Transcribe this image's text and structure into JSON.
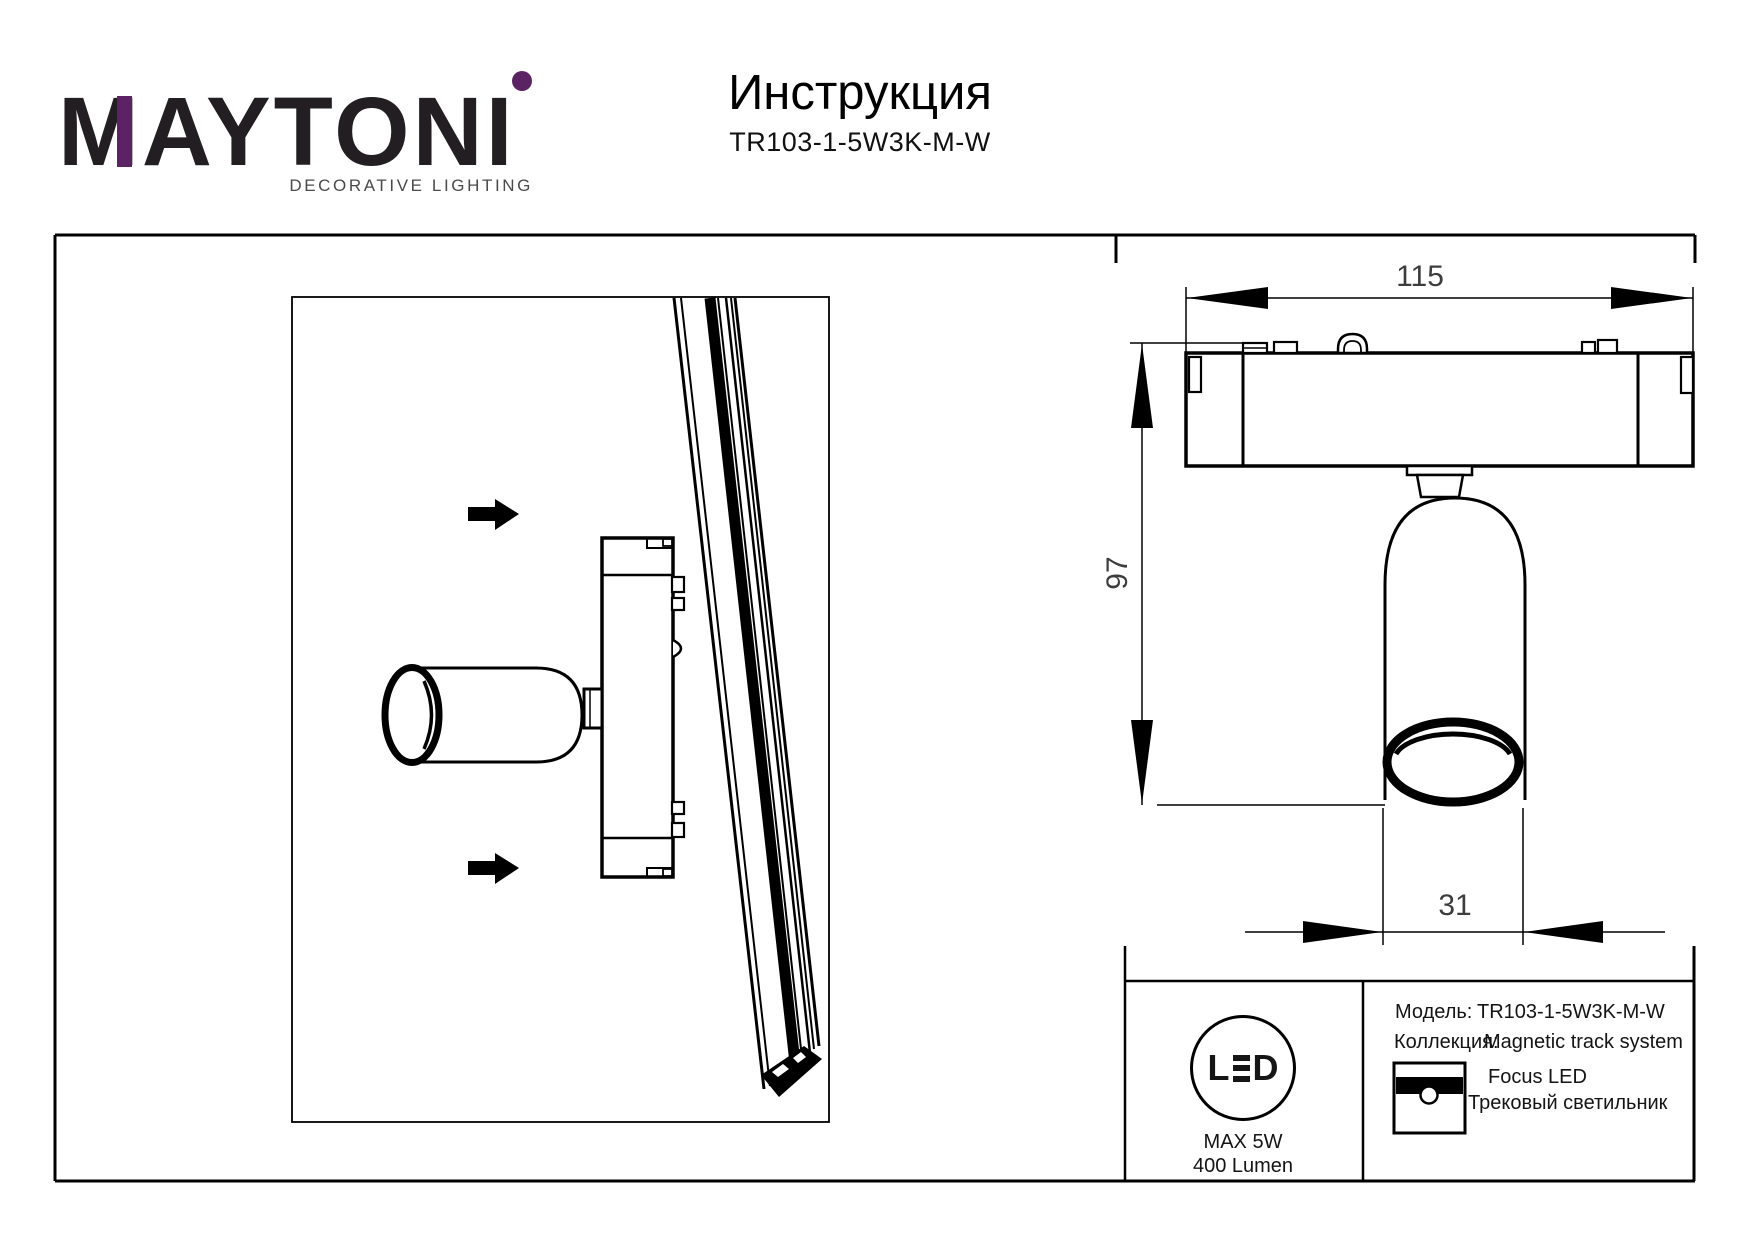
{
  "page": {
    "background": "#ffffff",
    "ink": "#000000",
    "accent_purple": "#5b2364"
  },
  "brand": {
    "wordmark_m": "M",
    "wordmark_mid": "AYTON",
    "wordmark_i": "I",
    "tagline": "DECORATIVE LIGHTING"
  },
  "header": {
    "title": "Инструкция",
    "model_code": "TR103-1-5W3K-M-W"
  },
  "drawing": {
    "dim_width_mm": "115",
    "dim_height_mm": "97",
    "dim_diameter_mm": "31"
  },
  "info_box": {
    "led_badge": {
      "letter_l": "L",
      "letter_d": "D",
      "max_power": "MAX 5W",
      "luminous_flux": "400 Lumen"
    },
    "model_label": "Модель:",
    "model_value": "TR103-1-5W3K-M-W",
    "collection_label": "Коллекция:",
    "collection_value": "Magnetic track system",
    "series_name": "Focus LED",
    "product_type": "Трековый светильник"
  }
}
